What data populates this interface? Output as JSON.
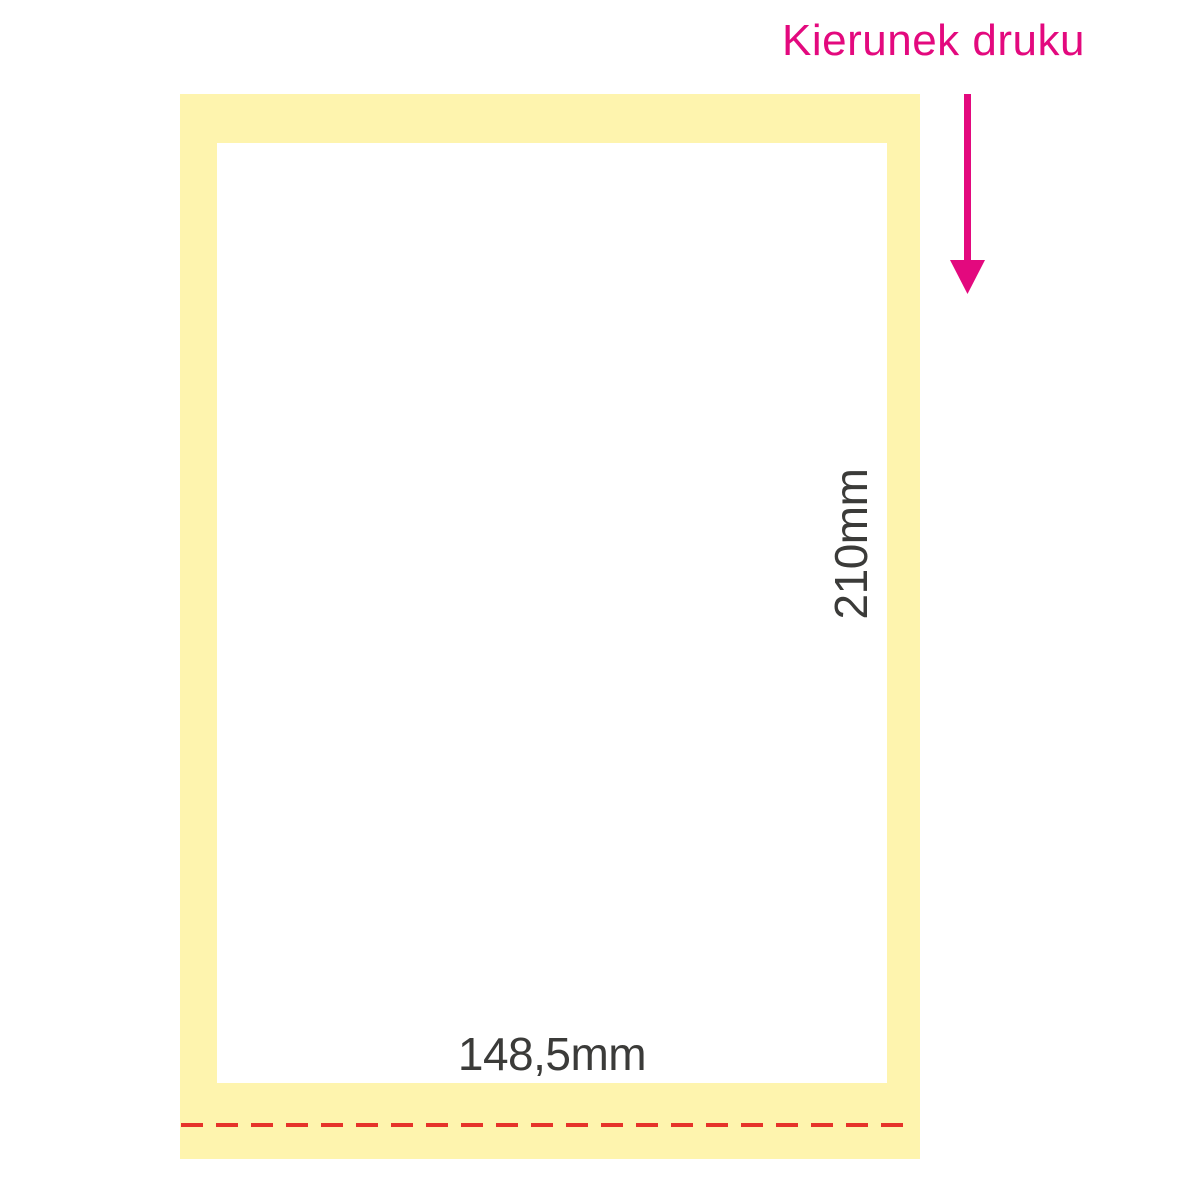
{
  "diagram": {
    "print_direction": {
      "label": "Kierunek druku",
      "arrow_icon": "arrow-down"
    },
    "dimensions": {
      "width": "148,5mm",
      "height": "210mm"
    },
    "colors": {
      "background": "#FFFFFF",
      "bleed_yellow": "#FEF4AE",
      "trim_white": "#FFFFFF",
      "magenta": "#E3097E",
      "fold_red": "#E6332A",
      "dimension_text": "#3B3B39"
    }
  }
}
